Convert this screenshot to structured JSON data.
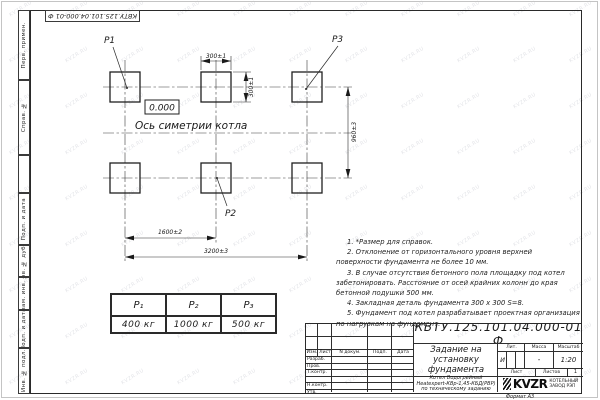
{
  "sheet": {
    "doc_number": "КВТУ.125.101.04.000-01 Ф",
    "format_label": "Формат А3",
    "watermark": "KVZR.RU",
    "paper_color": "#ffffff",
    "line_color": "#2a2a2a"
  },
  "margin_labels": [
    "Перв. примен.",
    "Справ. №",
    "",
    "Подп. и дата",
    "Инв. № дубл.",
    "Взам. инв. №",
    "Подп. и дата",
    "Инв. № подл."
  ],
  "drawing": {
    "point_labels": {
      "p1": "P1",
      "p2": "P2",
      "p3": "P3"
    },
    "elevation": "0.000",
    "axis_label": "Ось симетрии котла",
    "dimensions": {
      "top_width": "300±1",
      "side_height": "300±1",
      "row_spacing": "960±3",
      "col_spacing": "1600±2",
      "total_span": "3200±3"
    }
  },
  "notes": [
    "1. *Размер для справок.",
    "2. Отклонение от горизонтального уровня верхней поверхности фундамента не более 10 мм.",
    "3. В случае отсутствия бетонного пола площадку под котел забетонировать. Расстояние от осей крайних колонн до края бетонной подушки 500 мм.",
    "4. Закладная деталь фундамента  300 х 300  S=8.",
    "5. Фундамент под котел разрабатывает проектная организация по нагрузкам на фундамент."
  ],
  "load_table": {
    "headers": [
      "P₁",
      "P₂",
      "P₃"
    ],
    "values": [
      "400 кг",
      "1000 кг",
      "500 кг"
    ]
  },
  "title_block": {
    "doc_number": "КВТУ.125.101.04.000-01 Ф",
    "title_lines": [
      "Задание на",
      "установку",
      "фундамента"
    ],
    "product_lines": [
      "Котел Водогрейный",
      "Heatexpert-КВр-1,45-КБД(РВР)",
      "по техническому заданию"
    ],
    "header_cols": [
      "Изм.",
      "Лист",
      "N докум.",
      "Подп.",
      "Дата"
    ],
    "row_labels": [
      "Разраб.",
      "Пров.",
      "Т.контр.",
      "",
      "Н.контр.",
      "Утв."
    ],
    "lit_label": "Лит.",
    "mass_label": "Масса",
    "scale_label": "Масштаб",
    "lit_value": "И",
    "mass_value": "-",
    "scale_value": "1:20",
    "sheet_label": "Лист",
    "sheets_label": "Листов",
    "sheets_value": "1",
    "org": {
      "logo_text": "KVZR",
      "name_lines": [
        "КОТЕЛЬНЫЙ",
        "ЗАВОД РЭП"
      ]
    }
  }
}
